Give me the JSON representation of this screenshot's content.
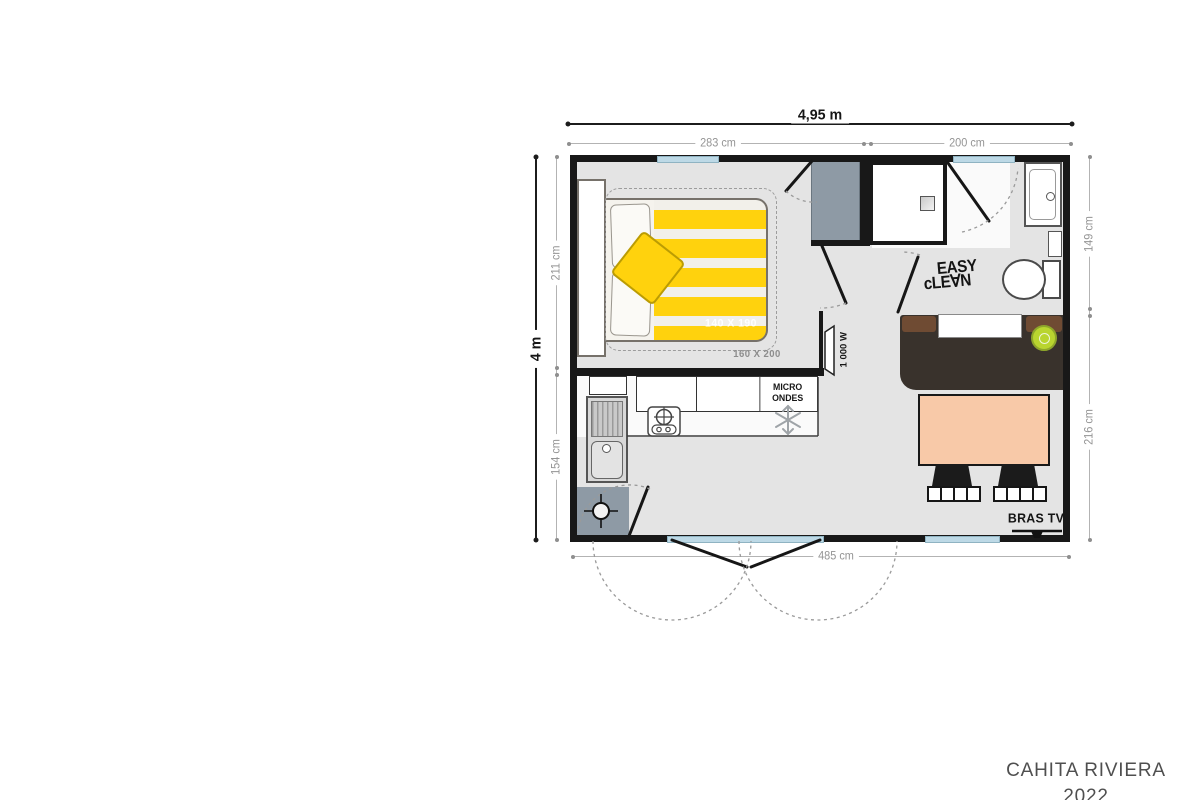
{
  "dims": {
    "overall_width": "4,95 m",
    "overall_depth": "4 m",
    "top_left": "283 cm",
    "top_right": "200 cm",
    "left_upper": "211 cm",
    "left_lower": "154 cm",
    "right_upper": "149 cm",
    "right_lower": "216 cm",
    "bottom": "485 cm"
  },
  "bedroom": {
    "bed_size": "140 X 190",
    "bed_clearance": "160 X 200"
  },
  "kitchen": {
    "microwave_line1": "MICRO",
    "microwave_line2": "ONDES"
  },
  "living": {
    "tv_label": "BRAS TV",
    "heater_label": "1 000 W"
  },
  "bathroom": {
    "easy": "EASY",
    "clean": "cLE∀N"
  },
  "footer": {
    "model": "CAHITA RIVIERA",
    "year": "2022"
  },
  "colors": {
    "wall": "#181818",
    "floor": "#e4e4e4",
    "window_glass": "#bdd9e6",
    "bed_yellow": "#ffd20d",
    "closet_gray": "#8e9aa5",
    "sideboard_brown": "#39322c",
    "sideboard_accent": "#6f4b33",
    "table_peach": "#f8c9a8",
    "stool_green": "#b9d52f",
    "dim_text": "#949494"
  },
  "icons": {
    "freezer": "snowflake-icon",
    "hob": "burner-cross-icon",
    "water_heater": "crosshair-circle-icon",
    "shower": "drain-square-icon",
    "tv_mount": "wall-bracket-icon"
  }
}
